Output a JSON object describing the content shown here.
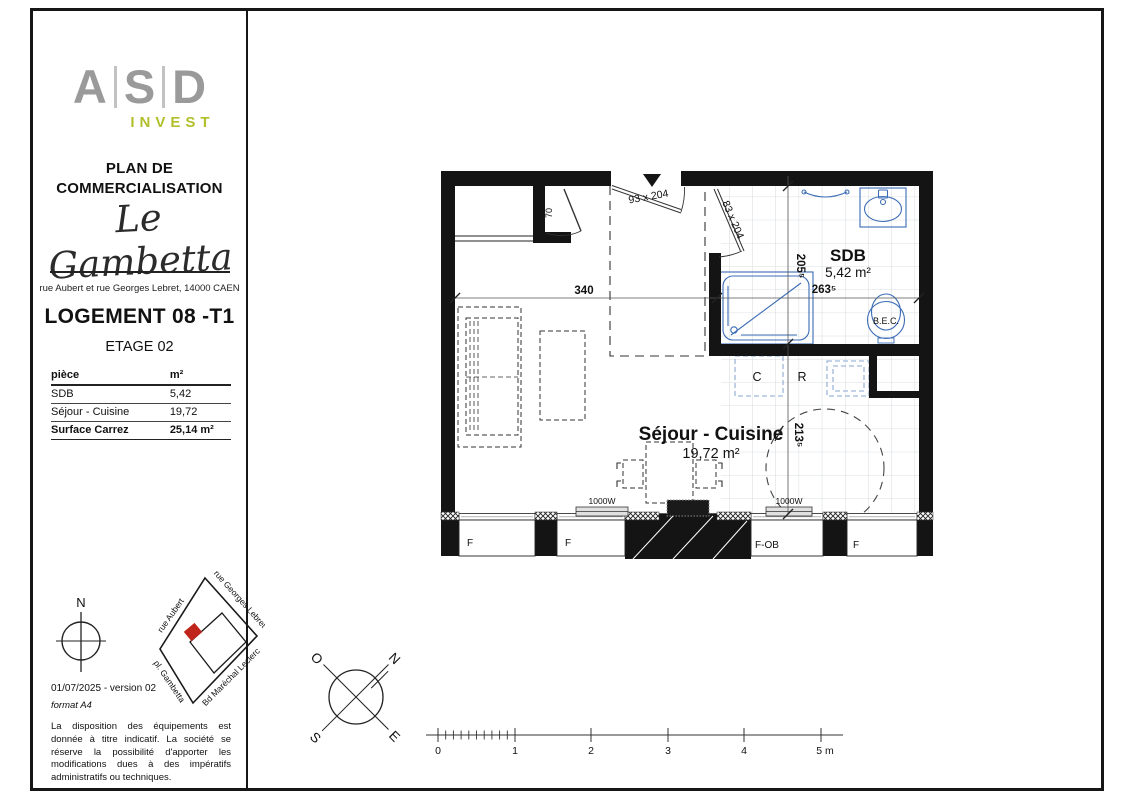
{
  "sidebar": {
    "logo": {
      "l1": "A",
      "l2": "S",
      "l3": "D",
      "sub": "INVEST"
    },
    "doc_title": "PLAN DE COMMERCIALISATION",
    "residence": "Le Gambetta",
    "address": "rue Aubert et rue Georges Lebret, 14000 CAEN",
    "unit": "LOGEMENT 08 -T1",
    "floor": "ETAGE 02",
    "areas_table": {
      "header_piece": "pièce",
      "header_m2": "m²",
      "rows": [
        {
          "piece": "SDB",
          "m2": "5,42"
        },
        {
          "piece": "Séjour - Cuisine",
          "m2": "19,72"
        }
      ],
      "total_label": "Surface Carrez",
      "total_value": "25,14 m²"
    },
    "north": "N",
    "map": {
      "street_top_left": "rue Aubert",
      "street_top_right": "rue Georges Lebret",
      "street_bottom_left": "pl. Gambetta",
      "street_bottom_right": "Bd Maréchal Leclerc"
    },
    "version": "01/07/2025 - version 02",
    "format": "format A4",
    "disclaimer": "La disposition des équipements est donnée à titre indicatif. La société se réserve la possibilité d'apporter les modifications dues à des impératifs administratifs ou techniques."
  },
  "plan": {
    "sdb": {
      "name": "SDB",
      "area": "5,42 m²"
    },
    "sejour": {
      "name": "Séjour - Cuisine",
      "area": "19,72 m²"
    },
    "labels": {
      "bec": "B.E.C.",
      "cupboard": "C",
      "fridge": "R",
      "radiator_left": "1000W",
      "radiator_right": "1000W",
      "window_f1": "F",
      "window_f2": "F",
      "window_fob": "F-OB",
      "window_f3": "F"
    },
    "dims": {
      "width_main": "340",
      "width_sdb": "263⁵",
      "height_sdb": "205⁵",
      "height_kitchen": "213⁵"
    },
    "doors": {
      "entrance": "93 x 204",
      "bathroom": "83 x 204",
      "closet": "70"
    }
  },
  "compass": {
    "o": "O",
    "n": "N",
    "s": "S",
    "e": "E"
  },
  "scale": {
    "t0": "0",
    "t1": "1",
    "t2": "2",
    "t3": "3",
    "t4": "4",
    "t5": "5 m"
  },
  "colors": {
    "fixture_blue": "#3b6cb5",
    "dashed_blue": "#8aa9d0",
    "marker_red": "#c0251c",
    "invest_green": "#b2bf2c"
  }
}
